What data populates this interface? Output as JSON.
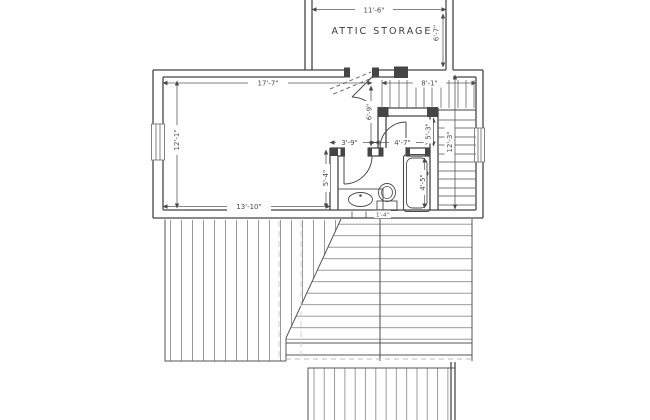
{
  "drawing": {
    "room_label": "ATTIC STORAGE",
    "dimensions": {
      "attic_width": "11'-6\"",
      "attic_depth": "6'-7\"",
      "room_width": "17'-7\"",
      "room_height": "12'-1\"",
      "room_width_bottom": "13'-10\"",
      "hall_width": "8'-1\"",
      "hall_depth": "12'-3\"",
      "door_to_bath": "6'-9\"",
      "bath_width_left": "3'-9\"",
      "bath_width_right": "4'-7\"",
      "bath_depth": "5'-4\"",
      "closet_depth": "5'-3\"",
      "tub_length": "4'-5\"",
      "toilet_clearance": "1'-4\""
    },
    "colors": {
      "line": "#4a4a4a",
      "hatch": "#8f8f8f",
      "hidden_line": "#bdbdbd",
      "background": "#ffffff"
    }
  }
}
